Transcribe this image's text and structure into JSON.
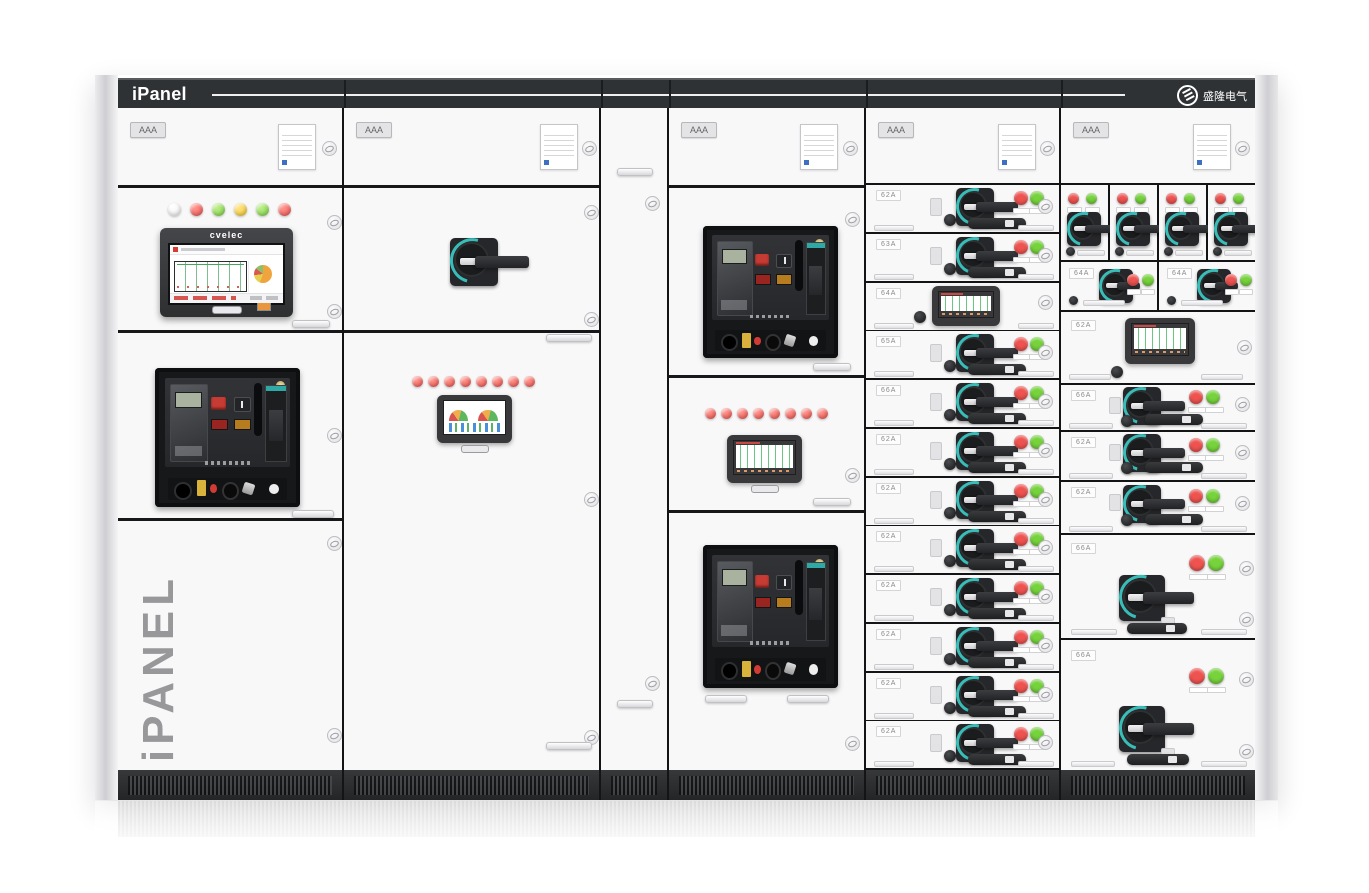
{
  "header": {
    "brand": "iPanel",
    "logo_text": "盛隆电气"
  },
  "cabinet": {
    "bay_label": "AAA",
    "side_label": "iPANEL",
    "hmi_brand": "cvelec"
  },
  "colors": {
    "band_dark": "#2f3235",
    "plinth_dark": "#2b2d2f",
    "accent_teal": "#38bdb8",
    "indicator_red": "#ef5350",
    "indicator_green": "#76d33c",
    "indicator_yellow": "#f0c72f",
    "indicator_white": "#ffffff"
  },
  "s1": {
    "lamps": [
      "white",
      "red",
      "green",
      "yellow",
      "green",
      "red"
    ]
  },
  "s2": {
    "lamp_count": 8,
    "lamp_color": "red"
  },
  "s4": {
    "lamp_count": 8,
    "lamp_color": "red"
  },
  "s5": {
    "rows": [
      {
        "label": "62A",
        "type": "switch"
      },
      {
        "label": "63A",
        "type": "switch"
      },
      {
        "label": "64A",
        "type": "display"
      },
      {
        "label": "65A",
        "type": "switch"
      },
      {
        "label": "66A",
        "type": "switch"
      },
      {
        "label": "62A",
        "type": "switch"
      },
      {
        "label": "62A",
        "type": "switch"
      },
      {
        "label": "62A",
        "type": "switch"
      },
      {
        "label": "62A",
        "type": "switch"
      },
      {
        "label": "62A",
        "type": "switch"
      },
      {
        "label": "62A",
        "type": "switch"
      },
      {
        "label": "62A",
        "type": "switch"
      }
    ]
  },
  "s6": {
    "row2": [
      {
        "label": "64A"
      },
      {
        "label": "64A"
      }
    ],
    "row3": {
      "label": "62A",
      "type": "display"
    },
    "row4": {
      "label": "66A"
    },
    "row5": {
      "label": "62A"
    },
    "row6": {
      "label": "62A"
    },
    "row7": {
      "label": "66A"
    },
    "row8": {
      "label": "66A"
    }
  }
}
